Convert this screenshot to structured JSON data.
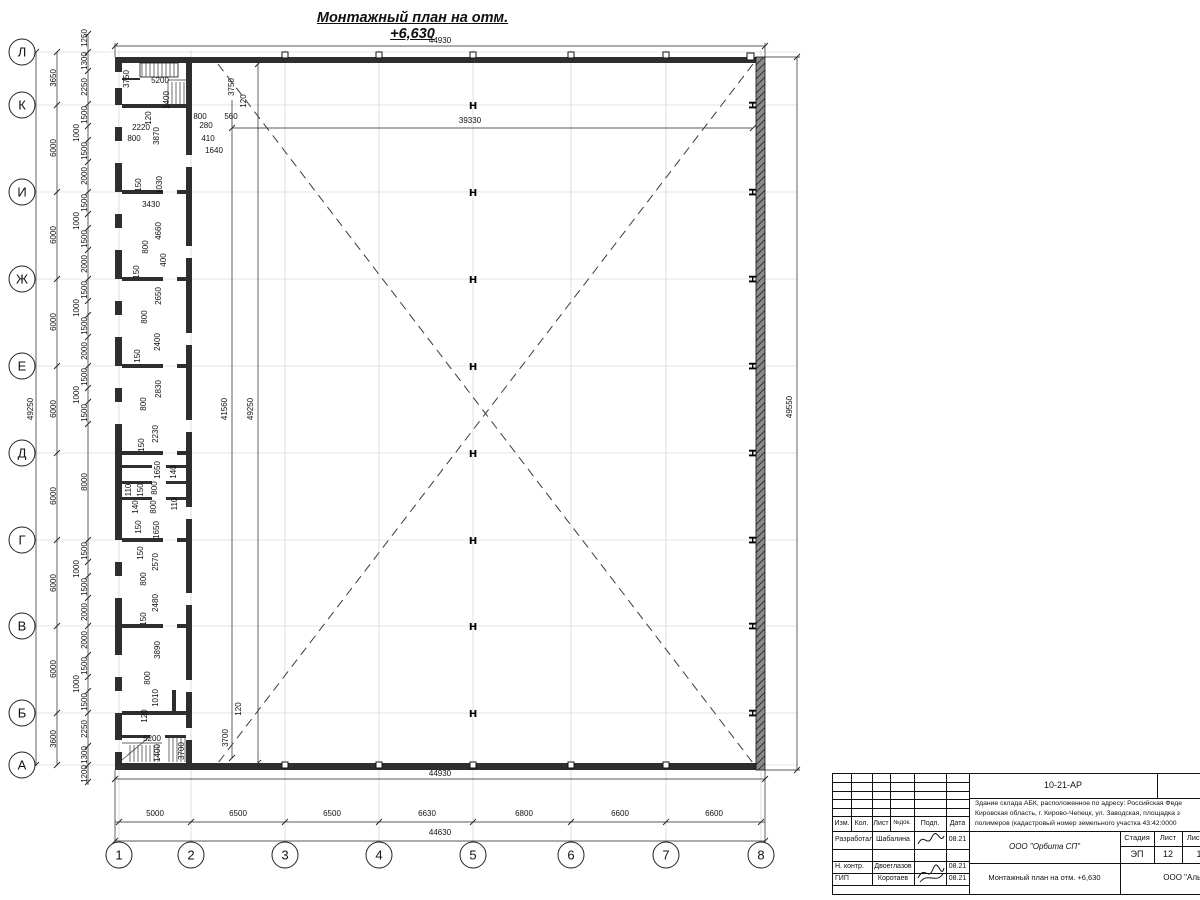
{
  "title": "Монтажный план на отм. +6,630",
  "colors": {
    "line": "#222222",
    "wall": "#2e2e2e",
    "grid": "#c9c9c9",
    "paper": "#ffffff"
  },
  "plan": {
    "row_axes": [
      {
        "label": "Л",
        "y": 52
      },
      {
        "label": "К",
        "y": 105
      },
      {
        "label": "И",
        "y": 192
      },
      {
        "label": "Ж",
        "y": 279
      },
      {
        "label": "Е",
        "y": 366
      },
      {
        "label": "Д",
        "y": 453
      },
      {
        "label": "Г",
        "y": 540
      },
      {
        "label": "В",
        "y": 626
      },
      {
        "label": "Б",
        "y": 713
      },
      {
        "label": "А",
        "y": 765
      }
    ],
    "col_axes": [
      {
        "label": "1",
        "x": 119
      },
      {
        "label": "2",
        "x": 191
      },
      {
        "label": "3",
        "x": 285
      },
      {
        "label": "4",
        "x": 379
      },
      {
        "label": "5",
        "x": 473
      },
      {
        "label": "6",
        "x": 571
      },
      {
        "label": "7",
        "x": 666
      },
      {
        "label": "8",
        "x": 761
      }
    ],
    "hall_columns": {
      "glyph": "H",
      "x": 473,
      "rows": [
        105,
        192,
        279,
        366,
        453,
        540,
        626,
        713
      ]
    },
    "wall_columns": {
      "glyph": "H",
      "x": 753,
      "rows": [
        105,
        192,
        279,
        366,
        453,
        540,
        626,
        713
      ]
    },
    "labels": [
      {
        "t": "44930",
        "x": 440,
        "y": 43
      },
      {
        "t": "3750",
        "x": 129,
        "y": 79,
        "r": 1
      },
      {
        "t": "5200",
        "x": 160,
        "y": 83
      },
      {
        "t": "1400",
        "x": 169,
        "y": 100,
        "r": 1
      },
      {
        "t": "120",
        "x": 151,
        "y": 118,
        "r": 1
      },
      {
        "t": "800",
        "x": 200,
        "y": 119
      },
      {
        "t": "280",
        "x": 206,
        "y": 128
      },
      {
        "t": "560",
        "x": 231,
        "y": 119
      },
      {
        "t": "2220",
        "x": 141,
        "y": 130
      },
      {
        "t": "800",
        "x": 134,
        "y": 141
      },
      {
        "t": "3870",
        "x": 159,
        "y": 136,
        "r": 1
      },
      {
        "t": "410",
        "x": 208,
        "y": 141
      },
      {
        "t": "1640",
        "x": 214,
        "y": 153
      },
      {
        "t": "3750",
        "x": 234,
        "y": 87,
        "r": 1
      },
      {
        "t": "120",
        "x": 246,
        "y": 101,
        "r": 1
      },
      {
        "t": "39330",
        "x": 470,
        "y": 123
      },
      {
        "t": "49250",
        "x": 33,
        "y": 409,
        "r": 1
      },
      {
        "t": "3650",
        "x": 56,
        "y": 78,
        "r": 1
      },
      {
        "t": "6000",
        "x": 56,
        "y": 148,
        "r": 1
      },
      {
        "t": "6000",
        "x": 56,
        "y": 235,
        "r": 1
      },
      {
        "t": "6000",
        "x": 56,
        "y": 322,
        "r": 1
      },
      {
        "t": "6000",
        "x": 56,
        "y": 409,
        "r": 1
      },
      {
        "t": "6000",
        "x": 56,
        "y": 496,
        "r": 1
      },
      {
        "t": "6000",
        "x": 56,
        "y": 583,
        "r": 1
      },
      {
        "t": "6000",
        "x": 56,
        "y": 669,
        "r": 1
      },
      {
        "t": "3600",
        "x": 56,
        "y": 739,
        "r": 1
      },
      {
        "t": "1250",
        "x": 87,
        "y": 38,
        "r": 1
      },
      {
        "t": "1300",
        "x": 87,
        "y": 61,
        "r": 1
      },
      {
        "t": "2250",
        "x": 87,
        "y": 87,
        "r": 1
      },
      {
        "t": "1500",
        "x": 87,
        "y": 115,
        "r": 1
      },
      {
        "t": "1000",
        "x": 79,
        "y": 133,
        "r": 1
      },
      {
        "t": "1500",
        "x": 87,
        "y": 151,
        "r": 1
      },
      {
        "t": "2000",
        "x": 87,
        "y": 176,
        "r": 1
      },
      {
        "t": "1500",
        "x": 87,
        "y": 203,
        "r": 1
      },
      {
        "t": "1000",
        "x": 79,
        "y": 221,
        "r": 1
      },
      {
        "t": "1500",
        "x": 87,
        "y": 239,
        "r": 1
      },
      {
        "t": "2000",
        "x": 87,
        "y": 264,
        "r": 1
      },
      {
        "t": "1500",
        "x": 87,
        "y": 290,
        "r": 1
      },
      {
        "t": "1000",
        "x": 79,
        "y": 308,
        "r": 1
      },
      {
        "t": "1500",
        "x": 87,
        "y": 326,
        "r": 1
      },
      {
        "t": "2000",
        "x": 87,
        "y": 351,
        "r": 1
      },
      {
        "t": "1500",
        "x": 87,
        "y": 377,
        "r": 1
      },
      {
        "t": "1000",
        "x": 79,
        "y": 395,
        "r": 1
      },
      {
        "t": "1500",
        "x": 87,
        "y": 413,
        "r": 1
      },
      {
        "t": "8000",
        "x": 87,
        "y": 482,
        "r": 1
      },
      {
        "t": "1500",
        "x": 87,
        "y": 551,
        "r": 1
      },
      {
        "t": "1000",
        "x": 79,
        "y": 569,
        "r": 1
      },
      {
        "t": "1500",
        "x": 87,
        "y": 587,
        "r": 1
      },
      {
        "t": "2000",
        "x": 87,
        "y": 612,
        "r": 1
      },
      {
        "t": "2000",
        "x": 87,
        "y": 640,
        "r": 1
      },
      {
        "t": "1500",
        "x": 87,
        "y": 666,
        "r": 1
      },
      {
        "t": "1000",
        "x": 79,
        "y": 684,
        "r": 1
      },
      {
        "t": "1500",
        "x": 87,
        "y": 702,
        "r": 1
      },
      {
        "t": "2250",
        "x": 87,
        "y": 729,
        "r": 1
      },
      {
        "t": "1300",
        "x": 87,
        "y": 755,
        "r": 1
      },
      {
        "t": "1200",
        "x": 87,
        "y": 774,
        "r": 1
      },
      {
        "t": "150",
        "x": 141,
        "y": 185,
        "r": 1
      },
      {
        "t": "1030",
        "x": 162,
        "y": 185,
        "r": 1
      },
      {
        "t": "3430",
        "x": 151,
        "y": 207
      },
      {
        "t": "4660",
        "x": 161,
        "y": 231,
        "r": 1
      },
      {
        "t": "800",
        "x": 148,
        "y": 247,
        "r": 1
      },
      {
        "t": "400",
        "x": 166,
        "y": 260,
        "r": 1
      },
      {
        "t": "150",
        "x": 139,
        "y": 272,
        "r": 1
      },
      {
        "t": "2650",
        "x": 161,
        "y": 296,
        "r": 1
      },
      {
        "t": "800",
        "x": 147,
        "y": 317,
        "r": 1
      },
      {
        "t": "2400",
        "x": 160,
        "y": 342,
        "r": 1
      },
      {
        "t": "150",
        "x": 140,
        "y": 356,
        "r": 1
      },
      {
        "t": "2830",
        "x": 161,
        "y": 389,
        "r": 1
      },
      {
        "t": "800",
        "x": 146,
        "y": 404,
        "r": 1
      },
      {
        "t": "2230",
        "x": 158,
        "y": 434,
        "r": 1
      },
      {
        "t": "150",
        "x": 144,
        "y": 445,
        "r": 1
      },
      {
        "t": "1650",
        "x": 160,
        "y": 470,
        "r": 1
      },
      {
        "t": "140",
        "x": 176,
        "y": 472,
        "r": 1
      },
      {
        "t": "110",
        "x": 131,
        "y": 490,
        "r": 1
      },
      {
        "t": "150",
        "x": 143,
        "y": 490,
        "r": 1
      },
      {
        "t": "800",
        "x": 157,
        "y": 488,
        "r": 1
      },
      {
        "t": "140",
        "x": 138,
        "y": 507,
        "r": 1
      },
      {
        "t": "800",
        "x": 156,
        "y": 507,
        "r": 1
      },
      {
        "t": "110",
        "x": 177,
        "y": 504,
        "r": 1
      },
      {
        "t": "150",
        "x": 141,
        "y": 527,
        "r": 1
      },
      {
        "t": "1650",
        "x": 159,
        "y": 530,
        "r": 1
      },
      {
        "t": "150",
        "x": 143,
        "y": 553,
        "r": 1
      },
      {
        "t": "2570",
        "x": 158,
        "y": 562,
        "r": 1
      },
      {
        "t": "800",
        "x": 146,
        "y": 579,
        "r": 1
      },
      {
        "t": "2480",
        "x": 158,
        "y": 603,
        "r": 1
      },
      {
        "t": "150",
        "x": 146,
        "y": 619,
        "r": 1
      },
      {
        "t": "3890",
        "x": 160,
        "y": 650,
        "r": 1
      },
      {
        "t": "800",
        "x": 150,
        "y": 678,
        "r": 1
      },
      {
        "t": "1010",
        "x": 158,
        "y": 698,
        "r": 1
      },
      {
        "t": "120",
        "x": 147,
        "y": 716,
        "r": 1
      },
      {
        "t": "5200",
        "x": 152,
        "y": 741
      },
      {
        "t": "1400",
        "x": 160,
        "y": 753,
        "r": 1
      },
      {
        "t": "3700",
        "x": 184,
        "y": 751,
        "r": 1
      },
      {
        "t": "3700",
        "x": 228,
        "y": 738,
        "r": 1
      },
      {
        "t": "120",
        "x": 241,
        "y": 709,
        "r": 1
      },
      {
        "t": "41560",
        "x": 227,
        "y": 409,
        "r": 1
      },
      {
        "t": "49250",
        "x": 253,
        "y": 409,
        "r": 1
      },
      {
        "t": "49550",
        "x": 792,
        "y": 407,
        "r": 1
      },
      {
        "t": "44930",
        "x": 440,
        "y": 776
      },
      {
        "t": "5000",
        "x": 155,
        "y": 816
      },
      {
        "t": "6500",
        "x": 238,
        "y": 816
      },
      {
        "t": "6500",
        "x": 332,
        "y": 816
      },
      {
        "t": "6630",
        "x": 427,
        "y": 816
      },
      {
        "t": "6800",
        "x": 524,
        "y": 816
      },
      {
        "t": "6600",
        "x": 620,
        "y": 816
      },
      {
        "t": "6600",
        "x": 714,
        "y": 816
      },
      {
        "t": "44630",
        "x": 440,
        "y": 835
      }
    ]
  },
  "titleblock": {
    "doc_number": "10-21-АР",
    "address_lines": [
      "Здание склада АБК, расположенное по адресу: Российская Феде",
      "Кировская область, г. Кирово-Чепецк, ул. Заводская, площадка з",
      "полимеров (кадастровый номер земельного участка 43:42:0000"
    ],
    "header_cols": [
      "Изм.",
      "Кол.",
      "Лист",
      "№док.",
      "Подп.",
      "Дата"
    ],
    "rows": [
      {
        "role": "Разработал",
        "name": "Шабалина",
        "date": "08.21"
      },
      {
        "role": "Н. контр.",
        "name": "Двоеглазов",
        "date": "08.21"
      },
      {
        "role": "ГИП",
        "name": "Коротаев",
        "date": "08.21"
      }
    ],
    "company": "ООО \"Орбита СП\"",
    "stage_label": "Стадия",
    "sheet_label": "Лист",
    "sheets_label": "Листов",
    "stage": "ЭП",
    "sheet": "12",
    "sheets": "1",
    "drawing_name": "Монтажный план на отм. +6,630",
    "org": "ООО \"Альянс\""
  }
}
